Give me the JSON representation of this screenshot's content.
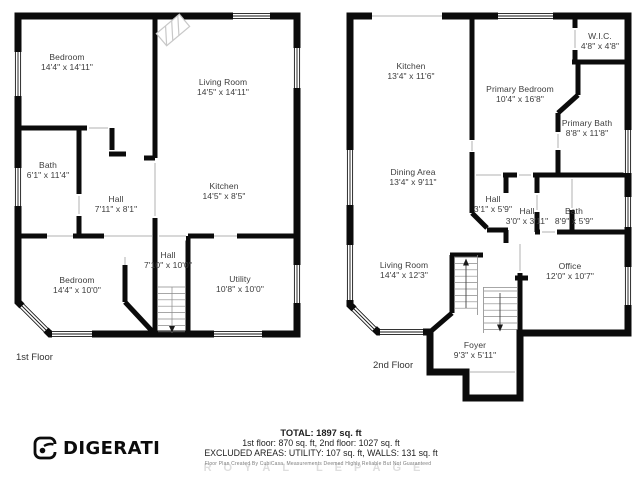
{
  "floors": [
    {
      "label": "1st Floor",
      "label_pos": {
        "x": 16,
        "y": 352
      },
      "rooms": [
        {
          "name": "Bedroom",
          "dims": "14'4\" x 14'11\"",
          "x": 67,
          "y": 62
        },
        {
          "name": "Living Room",
          "dims": "14'5\" x 14'11\"",
          "x": 223,
          "y": 87
        },
        {
          "name": "Bath",
          "dims": "6'1\" x 11'4\"",
          "x": 48,
          "y": 170
        },
        {
          "name": "Hall",
          "dims": "7'11\" x 8'1\"",
          "x": 116,
          "y": 204
        },
        {
          "name": "Kitchen",
          "dims": "14'5\" x 8'5\"",
          "x": 224,
          "y": 191
        },
        {
          "name": "Hall",
          "dims": "7'10\" x 10'0\"",
          "x": 168,
          "y": 260
        },
        {
          "name": "Bedroom",
          "dims": "14'4\" x 10'0\"",
          "x": 77,
          "y": 285
        },
        {
          "name": "Utility",
          "dims": "10'8\" x 10'0\"",
          "x": 240,
          "y": 284
        }
      ]
    },
    {
      "label": "2nd Floor",
      "label_pos": {
        "x": 373,
        "y": 360
      },
      "rooms": [
        {
          "name": "Kitchen",
          "dims": "13'4\" x 11'6\"",
          "x": 411,
          "y": 71
        },
        {
          "name": "W.I.C.",
          "dims": "4'8\" x 4'8\"",
          "x": 600,
          "y": 41
        },
        {
          "name": "Primary Bedroom",
          "dims": "10'4\" x 16'8\"",
          "x": 520,
          "y": 94
        },
        {
          "name": "Primary Bath",
          "dims": "8'8\" x 11'8\"",
          "x": 587,
          "y": 128
        },
        {
          "name": "Dining Area",
          "dims": "13'4\" x 9'11\"",
          "x": 413,
          "y": 177
        },
        {
          "name": "Hall",
          "dims": "3'1\" x 5'9\"",
          "x": 493,
          "y": 204
        },
        {
          "name": "Hall",
          "dims": "3'0\" x 3'11\"",
          "x": 527,
          "y": 216
        },
        {
          "name": "Bath",
          "dims": "8'9\" x 5'9\"",
          "x": 574,
          "y": 216
        },
        {
          "name": "Living Room",
          "dims": "14'4\" x 12'3\"",
          "x": 404,
          "y": 270
        },
        {
          "name": "Office",
          "dims": "12'0\" x 10'7\"",
          "x": 570,
          "y": 271
        },
        {
          "name": "Foyer",
          "dims": "9'3\" x 5'11\"",
          "x": 475,
          "y": 350
        }
      ]
    }
  ],
  "footer": {
    "total": "TOTAL: 1897 sq. ft",
    "floors": "1st floor: 870 sq. ft, 2nd floor: 1027 sq. ft",
    "excluded": "EXCLUDED AREAS: UTILITY: 107 sq. ft, WALLS: 131 sq. ft",
    "watermark_brand": "ROYAL LEPAGE",
    "watermark_note": "Floor Plan Created By CubiCasa. Measurements Deemed Highly Reliable But Not Guaranteed"
  },
  "logo": {
    "brand": "DIGERATI"
  },
  "colors": {
    "wall": "#0b0b0b",
    "window_line": "#161616",
    "opening_line": "#b0b0b0",
    "stair_line": "#8a8a8a",
    "label_text": "#3c3c3c"
  }
}
